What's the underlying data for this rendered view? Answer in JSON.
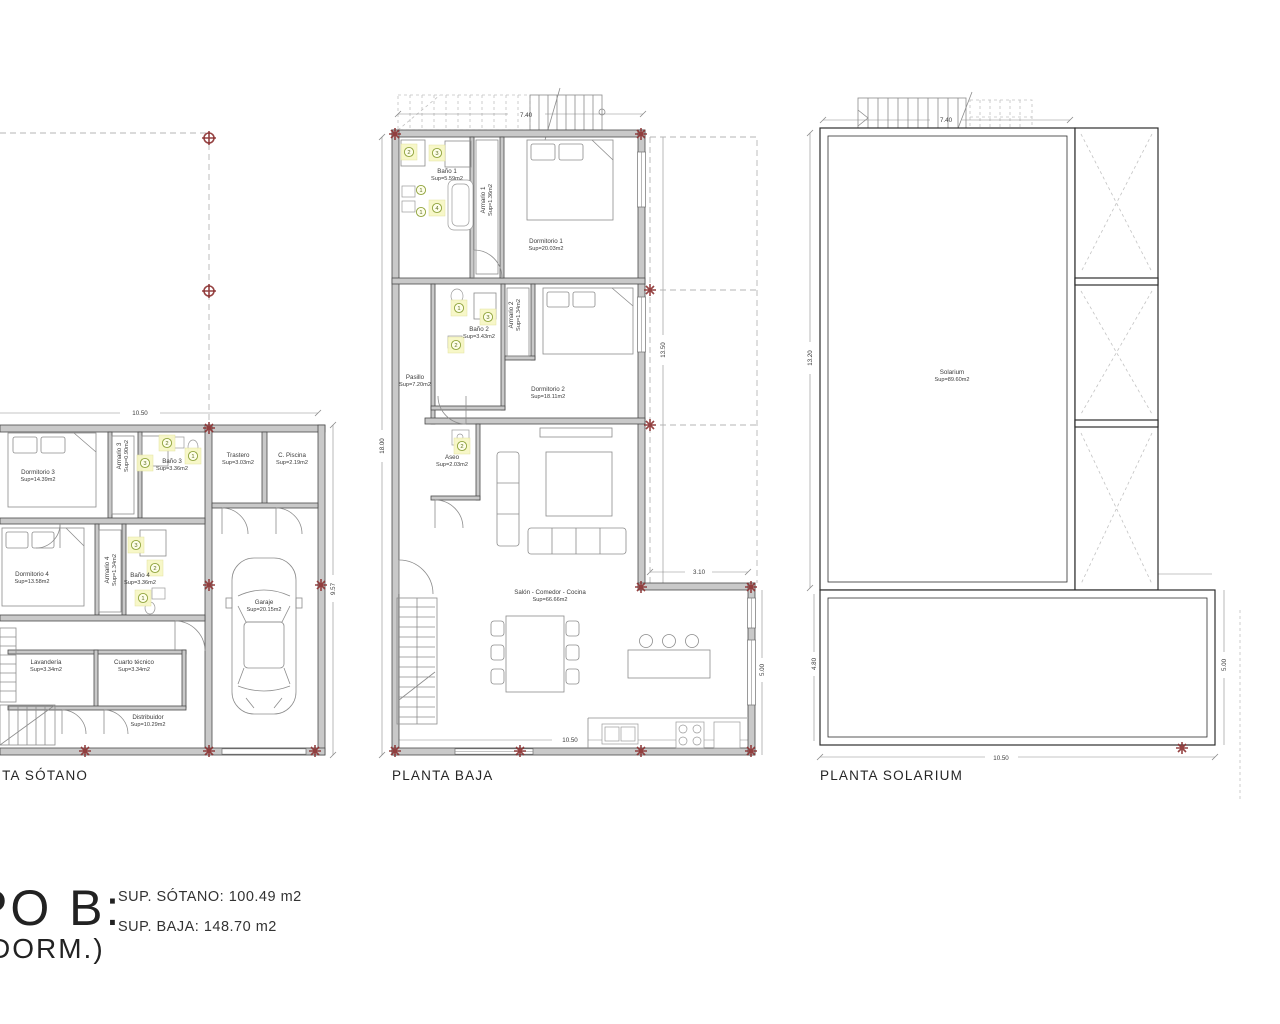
{
  "colors": {
    "wall_fill": "#c9c9c9",
    "wall_edge": "#4a4a4a",
    "pillar_red": "#8b3030",
    "projection_dash": "#b5b5b5",
    "badge_fill": "#f7f7c6",
    "badge_ring": "#8fa33c",
    "text": "#3c3c3c"
  },
  "title_block": {
    "line1": "PO B:",
    "line2": "DORM.)",
    "sup_sotano": "SUP. SÓTANO: 100.49 m2",
    "sup_baja": "SUP. BAJA: 148.70 m2"
  },
  "plans": {
    "sotano": {
      "label": "PLANTA SÓTANO",
      "dims": {
        "width": "10.50",
        "height": "9.57"
      },
      "rooms": {
        "dormitorio3": {
          "name": "Dormitorio 3",
          "area": "Sup=14.39m2"
        },
        "armario3": {
          "name": "Armario 3",
          "area": "Sup=0.90m2"
        },
        "bano3": {
          "name": "Baño 3",
          "area": "Sup=3.36m2"
        },
        "trastero": {
          "name": "Trastero",
          "area": "Sup=3.03m2"
        },
        "cpiscina": {
          "name": "C. Piscina",
          "area": "Sup=2.19m2"
        },
        "dormitorio4": {
          "name": "Dormitorio 4",
          "area": "Sup=13.58m2"
        },
        "armario4": {
          "name": "Armario 4",
          "area": "Sup=1.34m2"
        },
        "bano4": {
          "name": "Baño 4",
          "area": "Sup=3.36m2"
        },
        "garaje": {
          "name": "Garaje",
          "area": "Sup=20.15m2"
        },
        "lavanderia": {
          "name": "Lavandería",
          "area": "Sup=3.34m2"
        },
        "cuarto": {
          "name": "Cuarto técnico",
          "area": "Sup=3.34m2"
        },
        "distribuidor": {
          "name": "Distribuidor",
          "area": "Sup=10.29m2"
        }
      },
      "badges": {
        "bano3": [
          "3",
          "2",
          "1"
        ],
        "bano4": [
          "3",
          "2",
          "1"
        ]
      }
    },
    "baja": {
      "label": "PLANTA BAJA",
      "dims": {
        "top": "7.40",
        "left": "18.00",
        "right": "13.50",
        "porch_width": "3.10",
        "porch_height": "5.00",
        "bottom": "10.50"
      },
      "rooms": {
        "bano1": {
          "name": "Baño 1",
          "area": "Sup=5.59m2"
        },
        "armario1": {
          "name": "Armario 1",
          "area": "Sup=1.36m2"
        },
        "dormitorio1": {
          "name": "Dormitorio 1",
          "area": "Sup=20.03m2"
        },
        "bano2": {
          "name": "Baño 2",
          "area": "Sup=3.43m2"
        },
        "armario2": {
          "name": "Armario 2",
          "area": "Sup=1.34m2"
        },
        "dormitorio2": {
          "name": "Dormitorio 2",
          "area": "Sup=18.11m2"
        },
        "pasillo": {
          "name": "Pasillo",
          "area": "Sup=7.20m2"
        },
        "aseo": {
          "name": "Aseo",
          "area": "Sup=2.03m2"
        },
        "salon": {
          "name": "Salón - Comedor - Cocina",
          "area": "Sup=66.66m2"
        }
      },
      "badges": {
        "bano1": [
          "2",
          "3",
          "4",
          "1",
          "1"
        ],
        "bano2": [
          "1",
          "3",
          "2"
        ],
        "aseo": [
          "2"
        ]
      }
    },
    "solarium": {
      "label": "PLANTA SOLARIUM",
      "dims": {
        "top": "7.40",
        "left": "13.20",
        "right": "13.00",
        "lower_width": "3.10",
        "lower_left": "4.80",
        "lower_right": "5.00",
        "bottom": "10.50"
      },
      "rooms": {
        "solarium": {
          "name": "Solarium",
          "area": "Sup=89.60m2"
        }
      }
    }
  }
}
